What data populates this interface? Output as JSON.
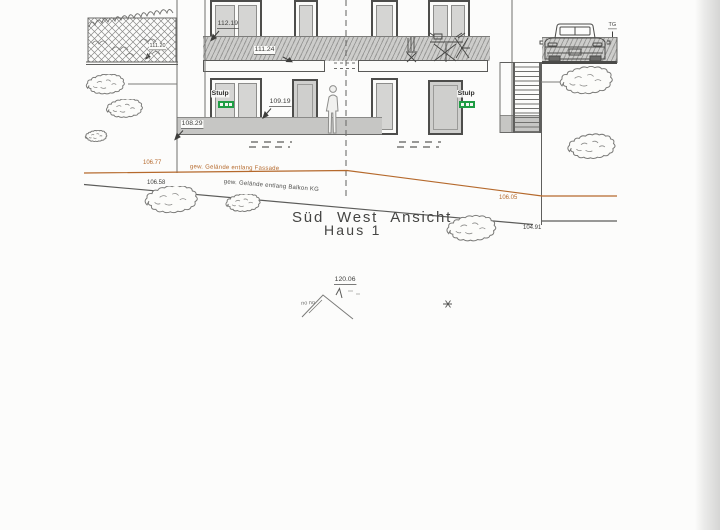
{
  "title": {
    "line1": "Süd West Ansicht",
    "line2": "Haus 1"
  },
  "annotations": {
    "stulp_left": "Stulp",
    "stulp_right": "Stulp",
    "terrain_fassade_label": "gew. Gelände entlang Fassade",
    "terrain_balkon_label": "gew. Gelände entlang Balkon KG",
    "garage": "TG",
    "sketch_note": "no no"
  },
  "levels": {
    "railing_top": "112.19",
    "slab_top": "111.24",
    "pergola_top": "111.20",
    "floor_upper": "109.19",
    "terrace": "108.29",
    "ridge": "120.06",
    "terrain_left_fassade": "106.77",
    "terrain_left_balkon": "106.58",
    "terrain_right_fassade": "106.05",
    "terrain_right_low": "104.91"
  },
  "colors": {
    "terrain_accent": "#b5692c",
    "stulp_green": "#1f9d44",
    "ink": "#4a4a48",
    "fill_gray": "#c6c6c4"
  }
}
